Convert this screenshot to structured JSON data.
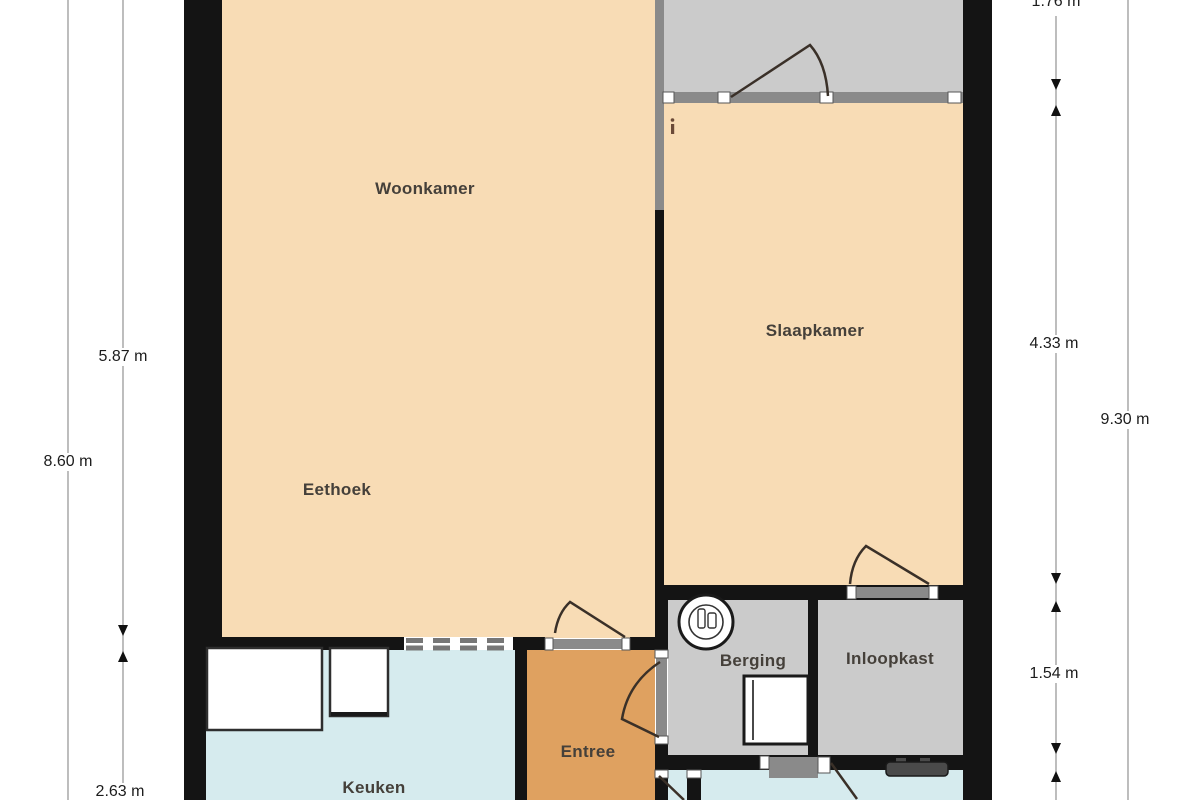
{
  "floorplan": {
    "rooms": [
      {
        "name": "woonkamer",
        "label": "Woonkamer"
      },
      {
        "name": "slaapkamer",
        "label": "Slaapkamer"
      },
      {
        "name": "eethoek",
        "label": "Eethoek"
      },
      {
        "name": "berging",
        "label": "Berging"
      },
      {
        "name": "inloopkast",
        "label": "Inloopkast"
      },
      {
        "name": "entree",
        "label": "Entree"
      },
      {
        "name": "keuken",
        "label": "Keuken"
      }
    ],
    "dimensions": {
      "left_inner_top": "5.87 m",
      "left_outer": "8.60 m",
      "left_inner_bottom": "2.63 m",
      "right_inner_top": "1.76 m",
      "right_inner_middle": "4.33 m",
      "right_inner_lower": "1.54 m",
      "right_outer": "9.30 m"
    },
    "icons": [
      "washing-machine-icon",
      "boiler-unit-icon",
      "radiator-icon",
      "kitchen-counter-icon",
      "door-swing-icon"
    ],
    "colors": {
      "room_fill": "#F8DCB5",
      "hall_fill": "#DFA160",
      "wet_room_fill": "#D6EBEE",
      "storage_fill": "#CBCBCB",
      "exterior_wall": "#141414",
      "interior_wall": "#8A8A8A",
      "dimension_line": "#9A9A9A",
      "label_text": "#45403A"
    }
  }
}
